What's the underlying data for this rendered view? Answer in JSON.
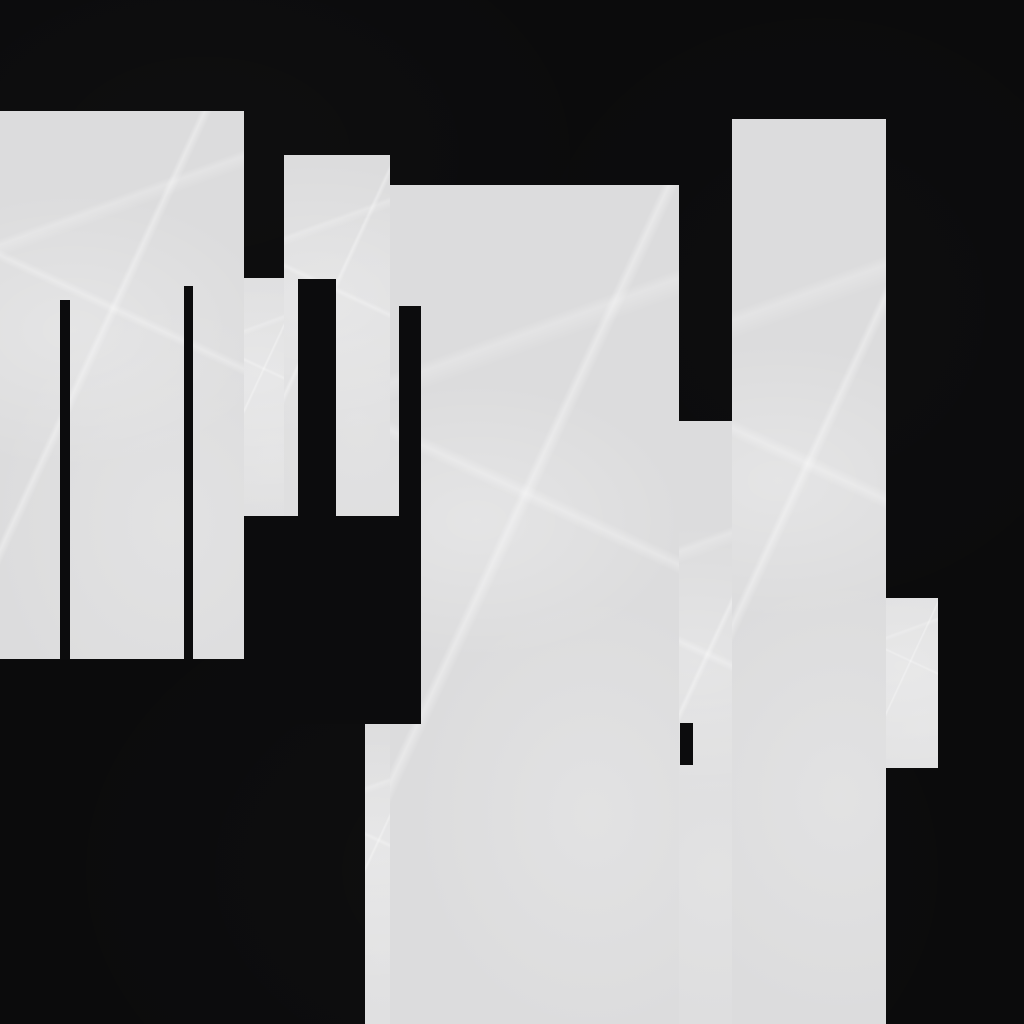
{
  "canvas": {
    "width": 1024,
    "height": 1024,
    "background_color": "#0b0b0c",
    "block_color": "#dcdcdd",
    "bar_color": "#0c0c0d",
    "description": "Abstract monochrome composition: irregular stepped light-gray mass with thin black vertical bars on a black textured background"
  },
  "gray_regions": [
    {
      "name": "left-block",
      "x": 0,
      "y": 111,
      "width": 244,
      "height": 548
    },
    {
      "name": "notch-connector",
      "x": 244,
      "y": 278,
      "width": 40,
      "height": 238
    },
    {
      "name": "tower-block",
      "x": 284,
      "y": 155,
      "width": 106,
      "height": 361
    },
    {
      "name": "center-slab",
      "x": 390,
      "y": 185,
      "width": 289,
      "height": 839
    },
    {
      "name": "gap-fill",
      "x": 679,
      "y": 421,
      "width": 53,
      "height": 603
    },
    {
      "name": "right-column",
      "x": 732,
      "y": 119,
      "width": 154,
      "height": 905
    },
    {
      "name": "right-bump",
      "x": 886,
      "y": 598,
      "width": 52,
      "height": 170
    },
    {
      "name": "bottom-left-extension",
      "x": 365,
      "y": 724,
      "width": 25,
      "height": 300
    }
  ],
  "black_details": [
    {
      "name": "left-thin-bar-1",
      "x": 60,
      "y": 300,
      "width": 10,
      "height": 359
    },
    {
      "name": "left-thin-bar-2",
      "x": 184,
      "y": 286,
      "width": 9,
      "height": 373
    },
    {
      "name": "wide-vertical-bar",
      "x": 298,
      "y": 279,
      "width": 38,
      "height": 237
    },
    {
      "name": "mid-vertical-bar",
      "x": 399,
      "y": 306,
      "width": 22,
      "height": 418
    },
    {
      "name": "lower-band",
      "x": 244,
      "y": 516,
      "width": 177,
      "height": 208
    },
    {
      "name": "small-notch-bar",
      "x": 680,
      "y": 723,
      "width": 13,
      "height": 42
    }
  ]
}
